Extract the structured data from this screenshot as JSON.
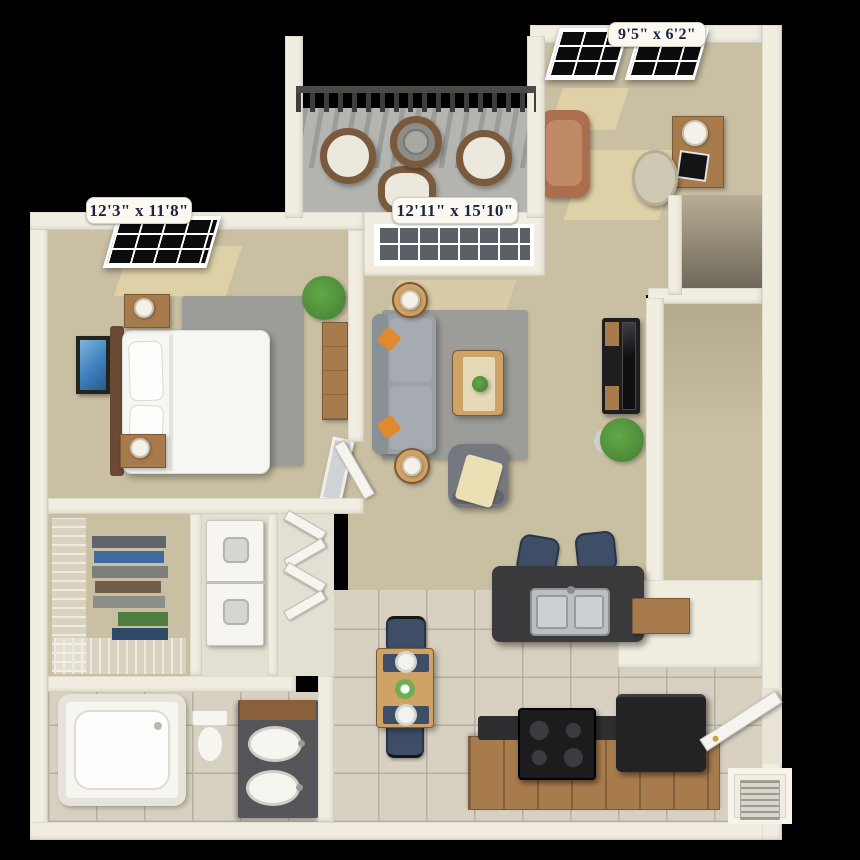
{
  "labels": {
    "bedroom": "12'3\" x 11'8\"",
    "living": "12'11\" x 15'10\"",
    "den": "9'5\" x 6'2\""
  },
  "colors": {
    "bg": "#000000",
    "wall": "#f1ede1",
    "walldark": "#d8d2c2",
    "carpet": "#c9bfa2",
    "carpetlight": "#e9ddb6",
    "tile": "#d8d1c1",
    "grout": "#b7b0a0",
    "rug": "#9c9c98",
    "balconyfloor": "#b4b4b0",
    "railing": "#3d3d3b",
    "wood": "#a87b4d",
    "wooddark": "#7b5936",
    "tablewood": "#cfa266",
    "navy": "#3d4e66",
    "orange": "#e08a2e",
    "sofa": "#9aa0a6",
    "armchairgray": "#75787e",
    "charcoal": "#3a3a3c",
    "appliance": "#232325",
    "white": "#f7f5ef",
    "steel": "#bcbfc1",
    "plant": "#4c8a39",
    "art": "#3d7fbe",
    "terracotta": "#ad6e4d",
    "beige": "#cfc8b2",
    "labeltext": "#1b2340",
    "cushion": "#ece8de"
  }
}
